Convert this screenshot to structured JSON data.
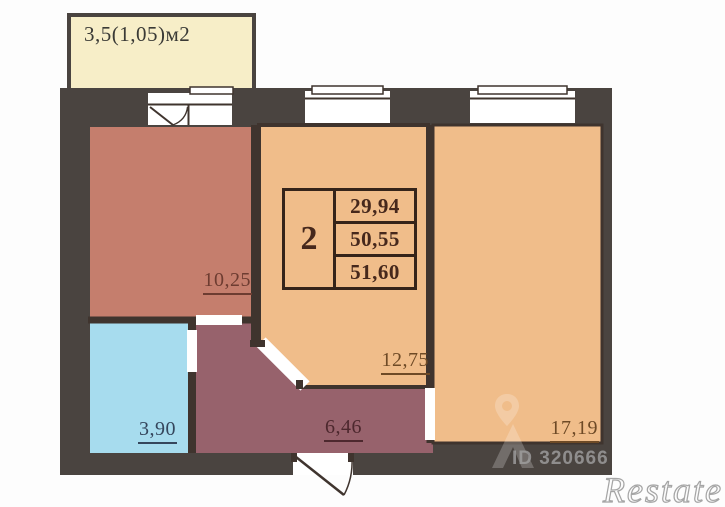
{
  "title": "2-room apartment floor plan",
  "colors": {
    "wall": "#4a4440",
    "partition": "#3f342e",
    "room_warm": "#f0bd8a",
    "room_salmon": "#c57e6d",
    "hallway": "#97626c",
    "bathroom": "#a7dcee",
    "balcony": "#f7eec8"
  },
  "balcony": {
    "label": "3,5(1,05)м2"
  },
  "rooms": [
    {
      "name": "room-left",
      "area": "10,25"
    },
    {
      "name": "room-middle",
      "area": "12,75"
    },
    {
      "name": "room-right",
      "area": "17,19"
    },
    {
      "name": "bathroom",
      "area": "3,90"
    },
    {
      "name": "hallway",
      "area": "6,46"
    }
  ],
  "info_table": {
    "rooms_count": "2",
    "areas": [
      "29,94",
      "50,55",
      "51,60"
    ]
  },
  "watermarks": {
    "listing_id": "ID 320666",
    "brand": "Restate"
  }
}
